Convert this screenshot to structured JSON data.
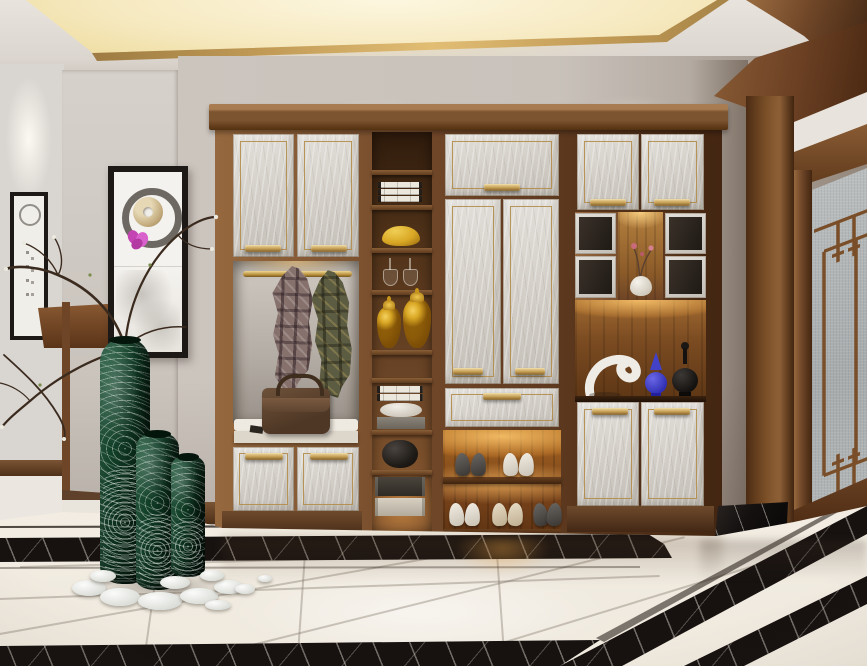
{
  "meta": {
    "type": "interior-photograph",
    "description": "Modern Chinese style entryway: walnut built-in hall cabinet with marble doors and brass handles, back-lit shoe shelves, open display shelving with yellow ginger jars, coat niche with plaid coats and leather bag, green glass floor vases with dry branches, framed ink artwork, frosted-glass lattice door and polished marble floor with black inlay border",
    "width": 867,
    "height": 666
  },
  "palette": {
    "wall": "#c9c2bb",
    "wall-deep": "#93867b",
    "hall-wall": "#d2ccc6",
    "hall-wall-far": "#d9d5d0",
    "ceiling": "#e6e1db",
    "cove-lit": "#f6e9c0",
    "cove-core": "#fdf7e0",
    "gold": "#c09a55",
    "gold-deep": "#7c5a24",
    "wood": "#6e4527",
    "wood-light": "#96683e",
    "wood-dark": "#432611",
    "panel-a": "#e2dfda",
    "panel-b": "#c3bfb7",
    "shelf-back": "#4e3118",
    "shelf-edge": "#7d5836",
    "glow": "#f5b95e",
    "glow-hot": "#ffd58a",
    "mirror": "#b3aca4",
    "cushion": "#efeae1",
    "bag": "#5e4431",
    "plaid-a": "#86716d",
    "plaid-b": "#5c5c43",
    "vase-green-a": "#1d5c3c",
    "vase-green-b": "#071f12",
    "jar-yellow": "#d9a724",
    "white-obj": "#efece6",
    "blue-obj": "#4643cf",
    "black-obj": "#161412",
    "floor-a": "#efe8dd",
    "floor-b": "#f6f1e8",
    "marble-dark": "#171210",
    "vein": "#d8d2c8",
    "frame": "#1c1917",
    "glass": "#b2b6b7",
    "branch": "#3b2b1f",
    "pebble": "#eef0ef",
    "baseboard": "#5f402a"
  },
  "labels": {
    "scene": "Modern Chinese style entryway with built-in hall cabinet",
    "ceiling": "Recessed cove-lit tray ceiling with gold trim and walnut beam",
    "hallway": "Side hallway with spot-lit framed ink artwork",
    "wall": "Entry wall",
    "artwork": "Framed enso ring, jade disc and orchid artwork",
    "cabinet": "Walnut entry cabinet with marble-faced doors and brass handles",
    "coat_area": "Open coat niche with brass rail, plaid coats and bench",
    "bag": "Brown leather handbag on bench cushion",
    "bookshelf": "Open display shelves with books, ginger jars, stemware and boxes",
    "wardrobe": "Tall marble wardrobe doors with drawer",
    "shoe_rack": "Warm back-lit shoe shelves with five pairs of shoes",
    "hutch": "Display hutch with cubbies, lit curio niche and sculptures",
    "sculpture": "Abstract white sculpture, blue lidded jar and black finial jar",
    "door": "Walnut framed frosted-glass door with Chinese lattice",
    "plinth": "Black marble door plinth",
    "floor": "Polished cream marble floor with black marble inlay border",
    "vases": "Carved green glass floor vases with dry blossom branches",
    "pebbles": "White decorative pebbles"
  }
}
